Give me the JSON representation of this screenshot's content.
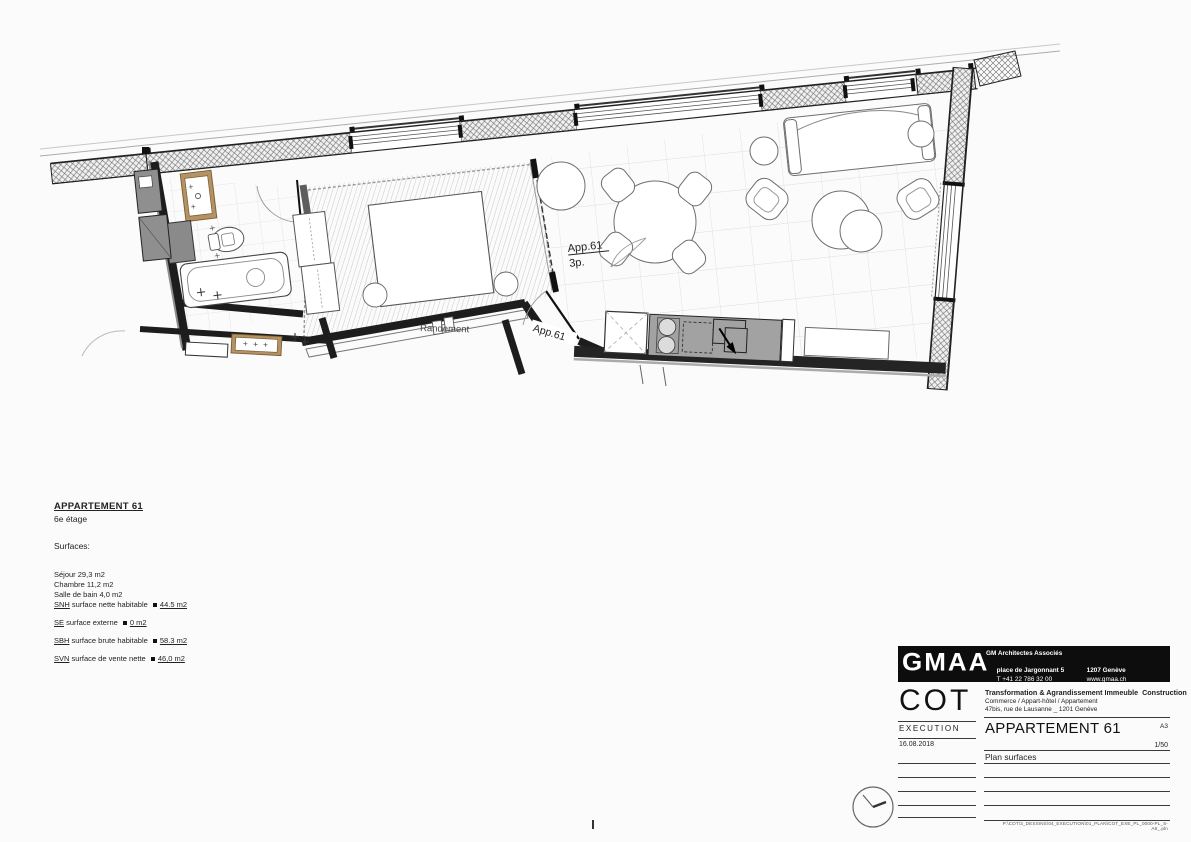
{
  "plan": {
    "unit_label": "App.61",
    "unit_rooms": "3p.",
    "entry_label": "App.61",
    "shaft_label": "Randement"
  },
  "surface_table": {
    "title": "APPARTEMENT 61",
    "floor": "6e étage",
    "section_label": "Surfaces:",
    "rooms": [
      "Séjour 29,3 m2",
      "Chambre 11,2 m2",
      "Salle de bain 4,0 m2"
    ],
    "totals": [
      {
        "abbr": "SNH",
        "label": " surface nette habitable ",
        "value": "44.5 m2"
      },
      {
        "abbr": "SE",
        "label": " surface externe ",
        "value": "0 m2"
      },
      {
        "abbr": "SBH",
        "label": " surface brute habitable ",
        "value": "58.3 m2"
      },
      {
        "abbr": "SVN",
        "label": " surface de vente nette ",
        "value": "46,0 m2"
      }
    ]
  },
  "title_block": {
    "firm_logo": "GMAA",
    "firm_name": "GM Architectes Associés",
    "firm_address": "place de Jargonnant 5",
    "firm_city": "1207 Genève",
    "firm_phone": "T +41 22 786 32 00",
    "firm_web": "www.gmaa.ch",
    "project_code": "COT",
    "project_line1": "Transformation & Agrandissement Immeuble  Construction",
    "project_line2": "Commerce / Appart-hôtel / Appartement",
    "project_line3": "47bis, rue de Lausanne _ 1201 Genève",
    "phase": "EXECUTION",
    "sheet_title": "APPARTEMENT 61",
    "format": "A3",
    "date": "16.08.2018",
    "scale": "1/50",
    "subtitle": "Plan surfaces",
    "file_path": "P:\\COT\\3_DESSINS\\04_EXECUTION\\01_PLAN\\COT_EXE_PL_0000-PL_S-A6_.pln"
  },
  "colors": {
    "wall": "#1d1d1d",
    "wood_cabinet": "#b49263",
    "kitchen_counter": "#a2a2a2",
    "banner_bg": "#0d0d0d"
  }
}
